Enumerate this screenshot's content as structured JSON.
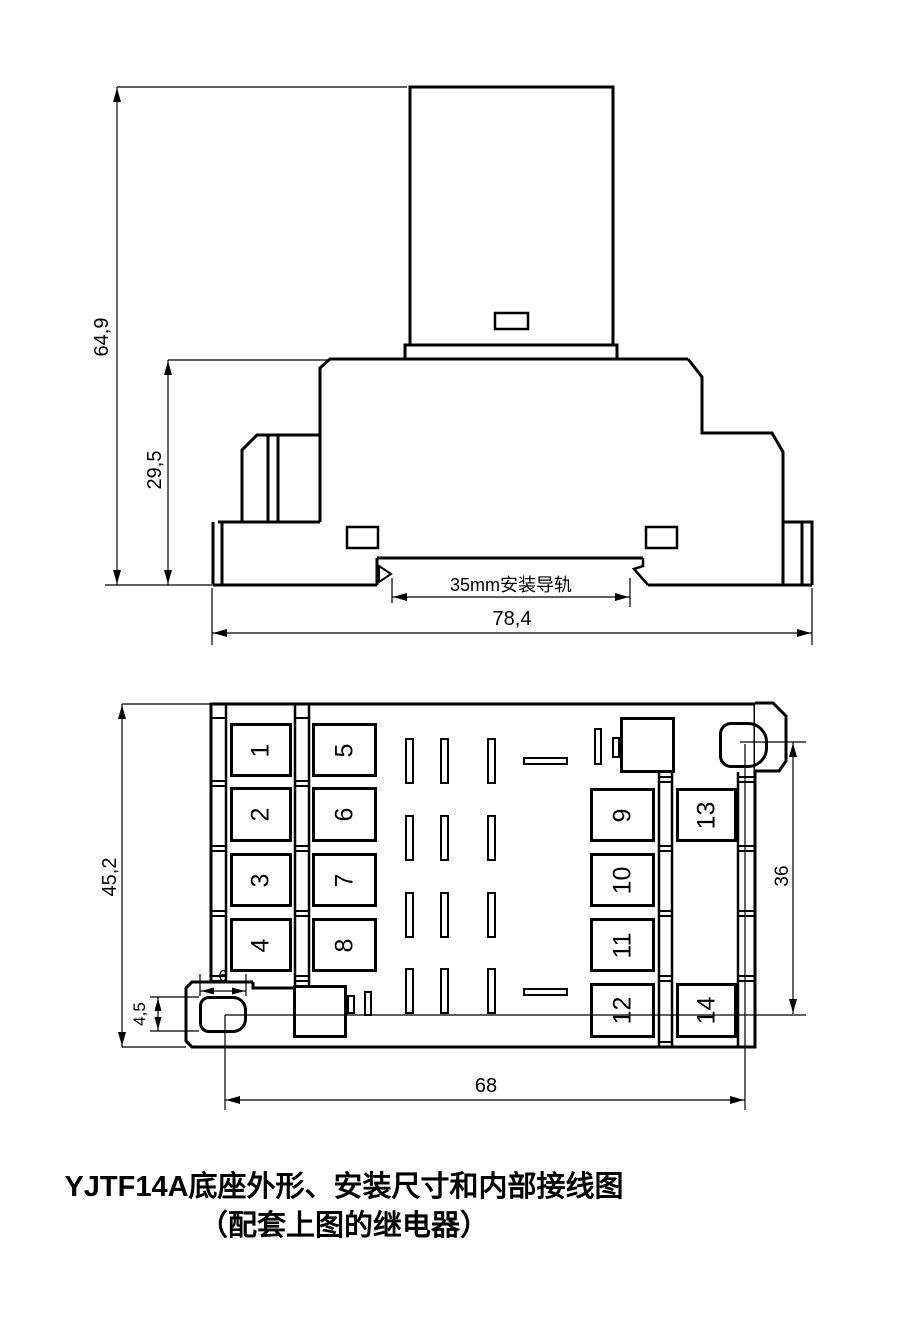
{
  "colors": {
    "line": "#000000",
    "bg": "#ffffff"
  },
  "side_view": {
    "dims": {
      "total_height": "64,9",
      "base_height": "29,5",
      "total_width": "78,4"
    },
    "rail_label": "35mm安装导轨"
  },
  "top_view": {
    "dims": {
      "total_height": "45,2",
      "hole_width": "6",
      "hole_height": "4,5",
      "hole_span_vertical": "36",
      "hole_span_horizontal": "68"
    },
    "terminals": [
      "1",
      "2",
      "3",
      "4",
      "5",
      "6",
      "7",
      "8",
      "9",
      "10",
      "11",
      "12",
      "13",
      "14"
    ]
  },
  "caption": {
    "line1": "YJTF14A底座外形、安装尺寸和内部接线图",
    "line2": "（配套上图的继电器）"
  }
}
